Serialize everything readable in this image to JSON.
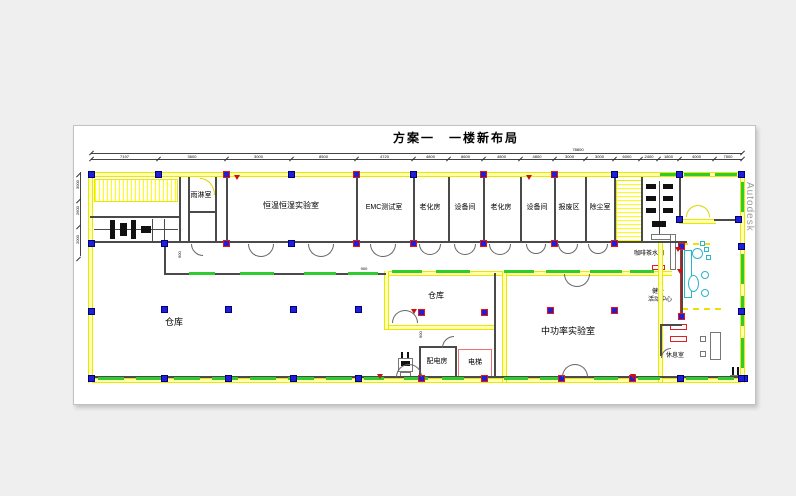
{
  "title": "方案一　一楼新布局",
  "watermark": "Autodesk",
  "colors": {
    "page_bg": "#efefef",
    "canvas_bg": "#ffffff",
    "wall_yellow": "#ffff00",
    "wall_dark": "#4a4a4a",
    "highlight_green": "#2ecc2e",
    "column_blue": "#1f1fd6",
    "column_red_outline": "#e81414",
    "accent_red": "#e02020",
    "furniture_cyan": "#2ab5c8",
    "watermark_gray": "#9c9c9c"
  },
  "rooms": {
    "yulinshi": "雨淋室",
    "hengwenhengshi": "恒温恒湿实验室",
    "emc": "EMC测试室",
    "laohua1": "老化房",
    "shebeijian1": "设备间",
    "laohua2": "老化房",
    "shebeijian2": "设备间",
    "baofeiqu": "报废区",
    "chuchenshi": "除尘室",
    "cangku_da": "仓库",
    "cangku_xiao": "仓库",
    "zhonggonglv": "中功率实验室",
    "peidianfang": "配电房",
    "dianti": "电梯",
    "kafei": "咖啡茶水间",
    "jianshen_line1": "健身",
    "jianshen_line2": "活动中心",
    "xiuxishi": "休息室"
  },
  "dimensions": {
    "overall": "78800",
    "top_segments": [
      "7197",
      "3600",
      "3000",
      "8500",
      "4720",
      "4800",
      "8600",
      "4800",
      "4800",
      "3000",
      "3000",
      "6000",
      "2400",
      "1800",
      "4000",
      "7500"
    ],
    "left_segments": [
      "3000",
      "2600",
      "2000"
    ],
    "micro": [
      "900",
      "900",
      "900"
    ]
  }
}
